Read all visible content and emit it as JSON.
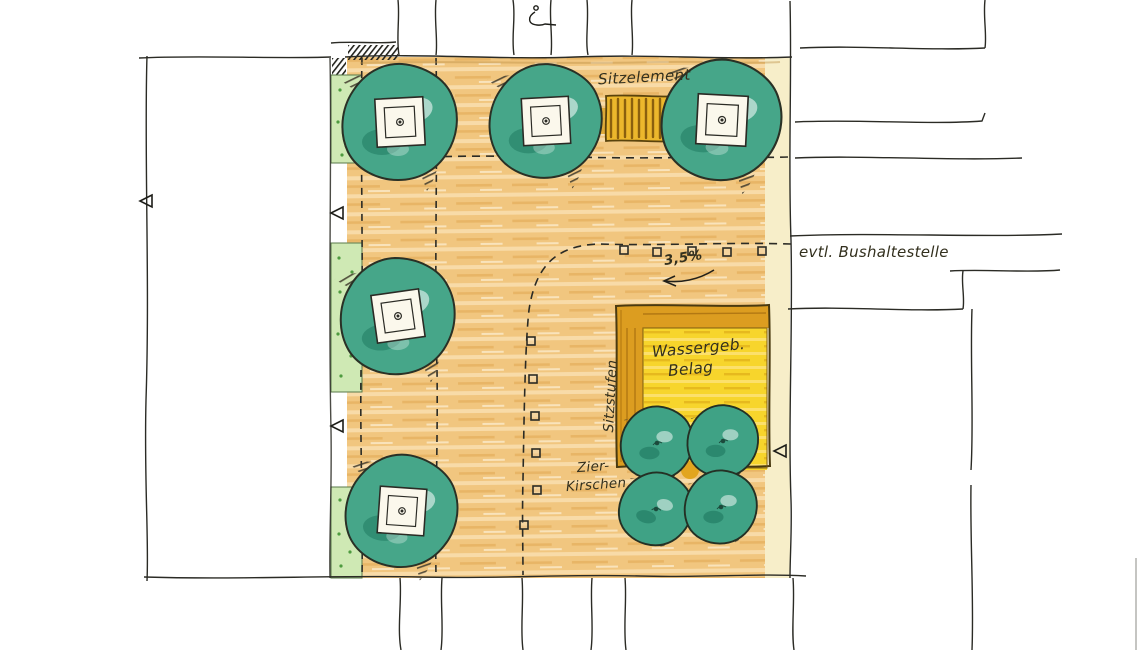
{
  "plan": {
    "labels": {
      "seating_element": "Sitzelement",
      "bus_stop": "evtl. Bushaltestelle",
      "slope": "3,5%",
      "surface_line1": "Wassergeb.",
      "surface_line2": "Belag",
      "seat_steps": "Sitzstufen",
      "cherries_line1": "Zier-",
      "cherries_line2": "Kirschen"
    },
    "colors": {
      "paving": "#f1c67f",
      "tree_canopy": "#46a689",
      "water_bound_surface": "#f7d52c",
      "steps_band": "#dc9d20",
      "planting_strip": "#cfe9b4",
      "bench": "#ecb72c",
      "ink": "#2b2b25"
    },
    "features": {
      "large_trees": 5,
      "ornamental_cherry_trees": 4,
      "bench_between_trees": 1,
      "bollards": 11
    }
  }
}
